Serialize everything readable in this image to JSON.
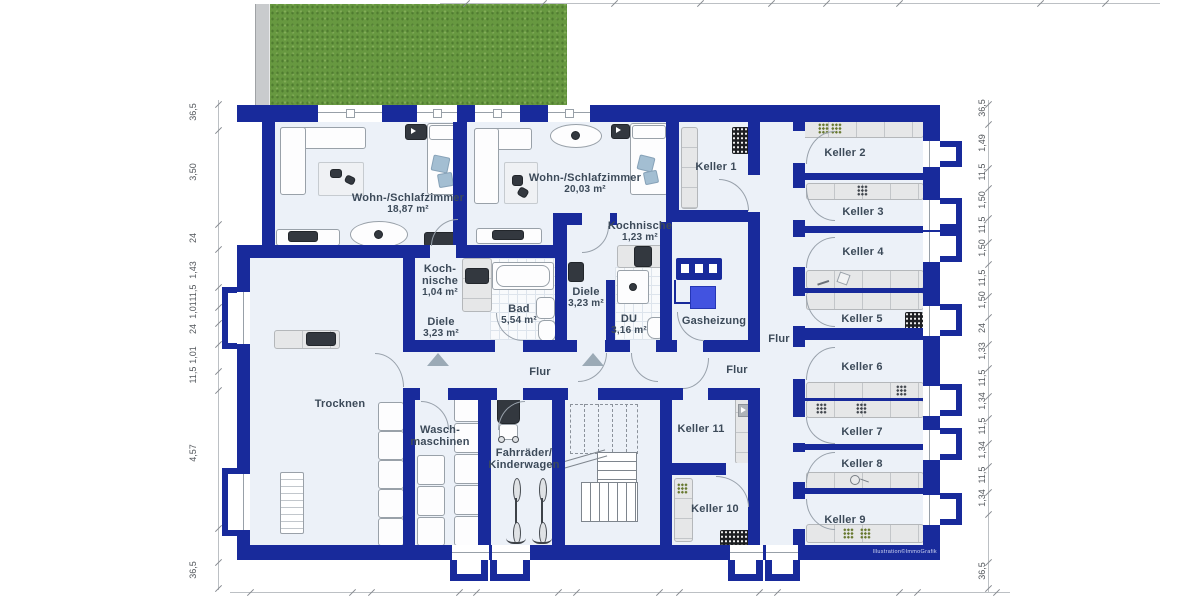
{
  "rooms": {
    "wohn1": {
      "name": "Wohn-/Schlafzimmer",
      "area": "18,87 m²"
    },
    "wohn2": {
      "name": "Wohn-/Schlafzimmer",
      "area": "20,03 m²"
    },
    "kochnische_apt2": {
      "name": "Kochnische",
      "area": "1,23 m²"
    },
    "kochnische_apt1": {
      "name_line1": "Koch-",
      "name_line2": "nische",
      "area": "1,04 m²"
    },
    "diele_apt1": {
      "name": "Diele",
      "area": "3,23 m²"
    },
    "bad": {
      "name": "Bad",
      "area": "5,54 m²"
    },
    "diele_apt2": {
      "name": "Diele",
      "area": "3,23 m²"
    },
    "du": {
      "name": "DU",
      "area": "3,16 m²"
    },
    "gasheizung": {
      "name": "Gasheizung"
    },
    "trocknen": {
      "name": "Trocknen"
    },
    "waschmaschinen": {
      "name_line1": "Wasch-",
      "name_line2": "maschinen"
    },
    "fahrraeder": {
      "name_line1": "Fahrräder/",
      "name_line2": "Kinderwagen"
    },
    "flur_main": {
      "name": "Flur"
    },
    "flur_mid": {
      "name": "Flur"
    },
    "flur_corridor": {
      "name": "Flur"
    },
    "keller1": {
      "name": "Keller 1"
    },
    "keller2": {
      "name": "Keller 2"
    },
    "keller3": {
      "name": "Keller 3"
    },
    "keller4": {
      "name": "Keller 4"
    },
    "keller5": {
      "name": "Keller 5"
    },
    "keller6": {
      "name": "Keller 6"
    },
    "keller7": {
      "name": "Keller 7"
    },
    "keller8": {
      "name": "Keller 8"
    },
    "keller9": {
      "name": "Keller 9"
    },
    "keller10": {
      "name": "Keller 10"
    },
    "keller11": {
      "name": "Keller 11"
    }
  },
  "dimensions": {
    "left": [
      "36,5",
      "3,50",
      "24",
      "1,43",
      "11,5",
      "1,01",
      "24",
      "1,01",
      "11,5",
      "4,57",
      "36,5"
    ],
    "right": [
      "36,5",
      "1,49",
      "11,5",
      "1,50",
      "11,5",
      "1,50",
      "11,5",
      "1,50",
      "24",
      "1,33",
      "11,5",
      "1,34",
      "11,5",
      "1,34",
      "11,5",
      "1,34",
      "36,5"
    ]
  },
  "footer": {
    "watermark": "Illustration©ImmoGrafik"
  },
  "colors": {
    "wall_blue": "#182a9b",
    "heater_blue": "#4253e0",
    "lawn_green": "#679840",
    "floor": "#ecf1f8",
    "label_text": "#3c4a59"
  }
}
